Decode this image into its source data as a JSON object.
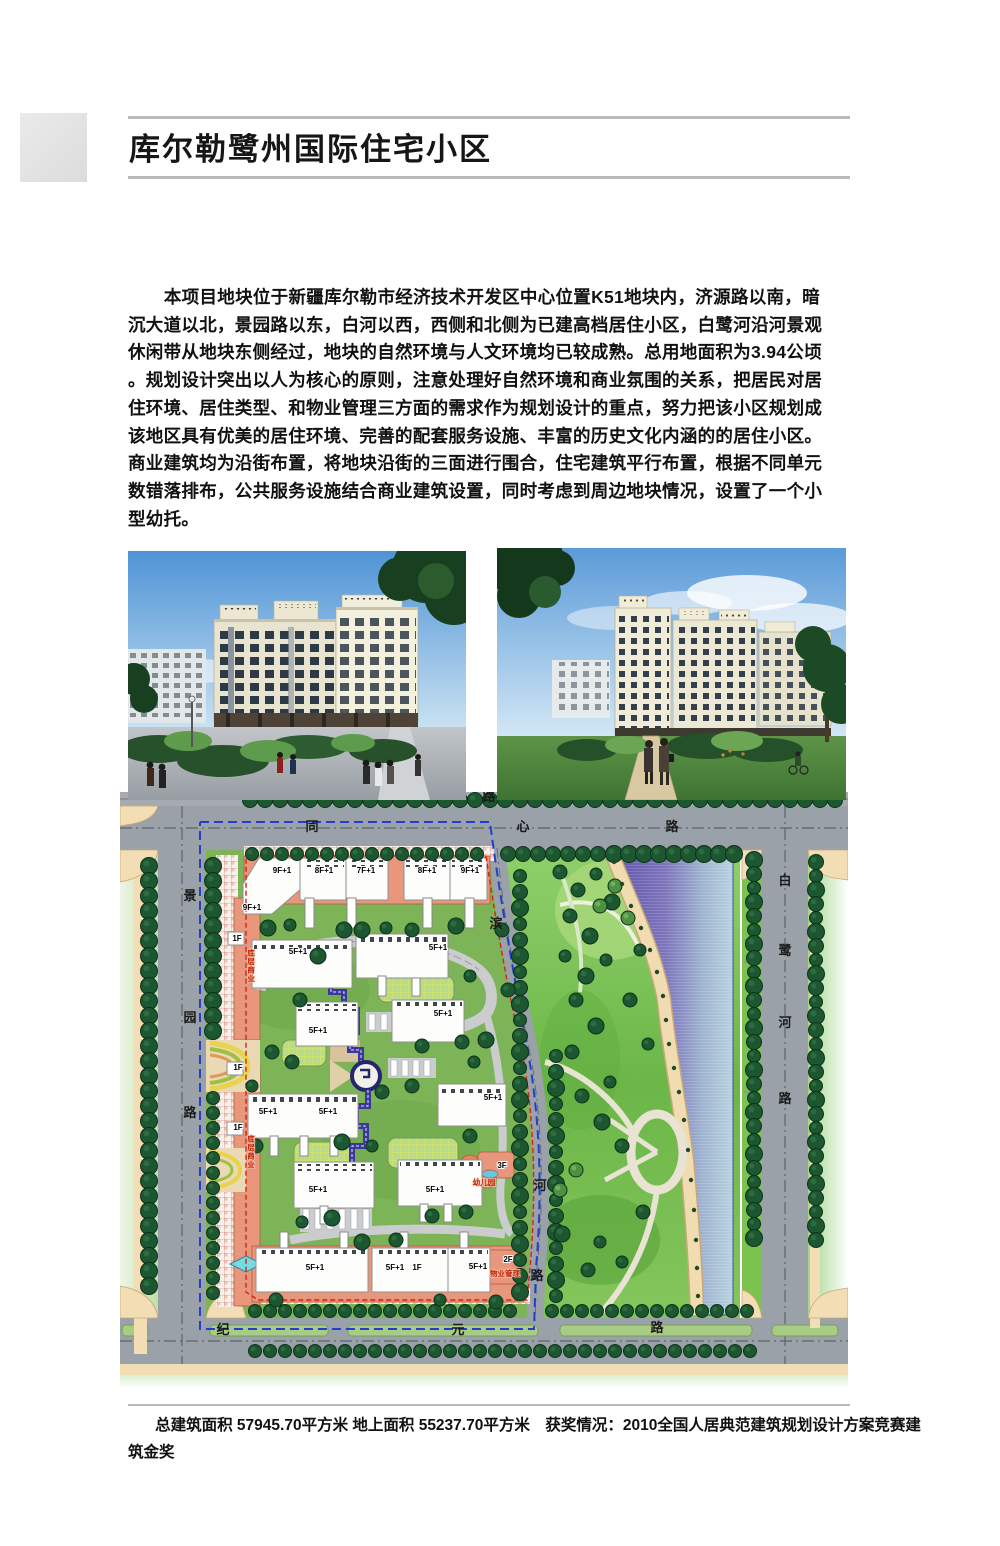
{
  "header": {
    "title": "库尔勒鹭州国际住宅小区"
  },
  "paragraph": {
    "lines": [
      "本项目地块位于新疆库尔勒市经济技术开发区中心位置K51地块内，济源路以南，暗",
      "沉大道以北，景园路以东，白河以西，西侧和北侧为已建高档居住小区，白鹭河沿河景观",
      "休闲带从地块东侧经过，地块的自然环境与人文环境均已较成熟。总用地面积为3.94公顷",
      "。规划设计突出以人为核心的原则，注意处理好自然环境和商业氛围的关系，把居民对居",
      "住环境、居住类型、和物业管理三方面的需求作为规划设计的重点，努力把该小区规划成",
      "该地区具有优美的居住环境、完善的配套服务设施、丰富的历史文化内涵的的居住小区。",
      "商业建筑均为沿街布置，将地块沿街的三面进行围合，住宅建筑平行布置，根据不同单元",
      "数错落排布，公共服务设施结合商业建筑设置，同时考虑到周边地块情况，设置了一个小",
      "型幼托。"
    ]
  },
  "footer": {
    "line1": "总建筑面积 57945.70平方米 地上面积 55237.70平方米　获奖情况：2010全国人居典范建筑规划设计方案竞赛建",
    "line2": "筑金奖"
  },
  "site_plan": {
    "colors": {
      "road": "#9aa1a8",
      "tree": "#1d5731",
      "river_west": "#5f54aa",
      "river_east": "#b7d2e0",
      "commercial": "#e8967c",
      "boundary_blue": "#2040cc",
      "boundary_red": "#d42410",
      "sidewalk": "#f2ddb4",
      "park": "#7cc050"
    },
    "road_labels": [
      {
        "text": "同",
        "x": 312,
        "y": 831
      },
      {
        "text": "心",
        "x": 523,
        "y": 831
      },
      {
        "text": "路",
        "x": 672,
        "y": 831
      },
      {
        "text": "路",
        "x": 489,
        "y": 801
      },
      {
        "text": "景",
        "x": 190,
        "y": 900
      },
      {
        "text": "园",
        "x": 190,
        "y": 1022
      },
      {
        "text": "路",
        "x": 190,
        "y": 1117
      },
      {
        "text": "白",
        "x": 785,
        "y": 885
      },
      {
        "text": "鹭",
        "x": 785,
        "y": 955
      },
      {
        "text": "河",
        "x": 785,
        "y": 1027
      },
      {
        "text": "路",
        "x": 785,
        "y": 1103
      },
      {
        "text": "滨",
        "x": 496,
        "y": 928
      },
      {
        "text": "河",
        "x": 540,
        "y": 1190
      },
      {
        "text": "路",
        "x": 537,
        "y": 1280
      },
      {
        "text": "纪",
        "x": 223,
        "y": 1334
      },
      {
        "text": "元",
        "x": 458,
        "y": 1334
      },
      {
        "text": "路",
        "x": 657,
        "y": 1332
      }
    ],
    "building_labels": [
      {
        "text": "9F+1",
        "x": 282,
        "y": 873
      },
      {
        "text": "8F+1",
        "x": 324,
        "y": 873
      },
      {
        "text": "7F+1",
        "x": 366,
        "y": 873
      },
      {
        "text": "8F+1",
        "x": 427,
        "y": 873
      },
      {
        "text": "9F+1",
        "x": 470,
        "y": 873
      },
      {
        "text": "9F+1",
        "x": 252,
        "y": 910
      },
      {
        "text": "1F",
        "x": 237,
        "y": 941
      },
      {
        "text": "5F+1",
        "x": 298,
        "y": 954
      },
      {
        "text": "5F+1",
        "x": 438,
        "y": 950
      },
      {
        "text": "5F+1",
        "x": 318,
        "y": 1033
      },
      {
        "text": "5F+1",
        "x": 443,
        "y": 1016
      },
      {
        "text": "1F",
        "x": 238,
        "y": 1070
      },
      {
        "text": "5F+1",
        "x": 268,
        "y": 1114
      },
      {
        "text": "5F+1",
        "x": 328,
        "y": 1114
      },
      {
        "text": "5F+1",
        "x": 493,
        "y": 1100
      },
      {
        "text": "1F",
        "x": 238,
        "y": 1130
      },
      {
        "text": "5F+1",
        "x": 318,
        "y": 1192
      },
      {
        "text": "5F+1",
        "x": 435,
        "y": 1192
      },
      {
        "text": "5F+1",
        "x": 315,
        "y": 1270
      },
      {
        "text": "5F+1",
        "x": 395,
        "y": 1270
      },
      {
        "text": "1F",
        "x": 417,
        "y": 1270
      },
      {
        "text": "5F+1",
        "x": 478,
        "y": 1269
      },
      {
        "text": "2F",
        "x": 508,
        "y": 1262
      },
      {
        "text": "3F",
        "x": 502,
        "y": 1168
      }
    ],
    "red_labels": [
      {
        "text": "底层商业",
        "x": 251,
        "y": 966,
        "v": true
      },
      {
        "text": "底层商业",
        "x": 251,
        "y": 1152,
        "v": true
      },
      {
        "text": "幼儿园",
        "x": 484,
        "y": 1185
      },
      {
        "text": "物业管理",
        "x": 505,
        "y": 1276
      }
    ]
  }
}
